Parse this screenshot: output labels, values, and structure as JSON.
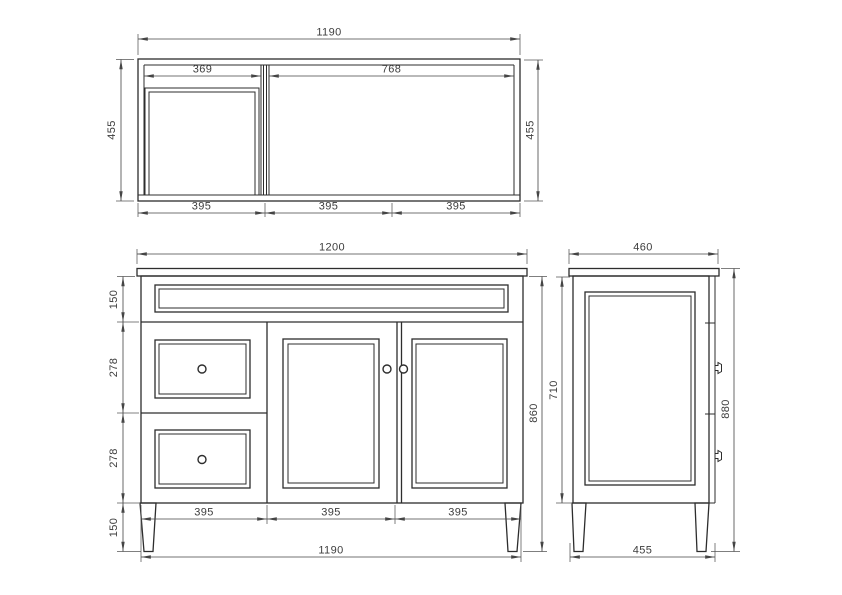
{
  "drawing": {
    "background": "#ffffff",
    "ink": "#2d2d2d",
    "dim_ink": "#454545",
    "top_view": {
      "overall_width": "1190",
      "depth_left": "455",
      "depth_right": "455",
      "left_opening": "369",
      "right_opening": "768",
      "front_segments": [
        "395",
        "395",
        "395"
      ]
    },
    "front_view": {
      "counter_width": "1200",
      "top_rail_height": "150",
      "upper_drawer_height": "278",
      "lower_drawer_height": "278",
      "leg_height": "150",
      "door_segments": [
        "395",
        "395",
        "395"
      ],
      "cabinet_width": "1190",
      "cabinet_height": "860"
    },
    "side_view": {
      "counter_depth": "460",
      "body_height": "710",
      "overall_height": "880",
      "base_depth": "455"
    }
  }
}
